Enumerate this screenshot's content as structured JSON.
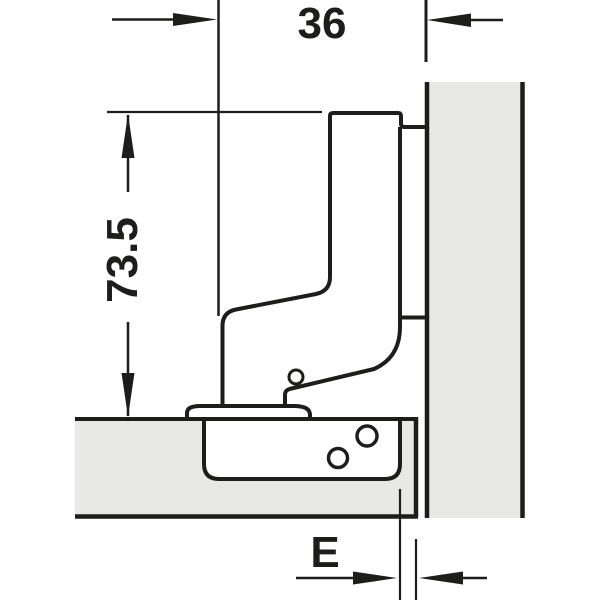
{
  "diagram": {
    "type": "technical-drawing",
    "subject": "concealed-cabinet-hinge-cross-section-with-mounting-dimensions",
    "labels": {
      "top_width": "36",
      "left_height": "73.5",
      "edge_distance": "E"
    },
    "colors": {
      "line": "#1d1d1b",
      "panel_fill": "#e8e8e6",
      "cutout_fill": "#ffffff"
    }
  }
}
